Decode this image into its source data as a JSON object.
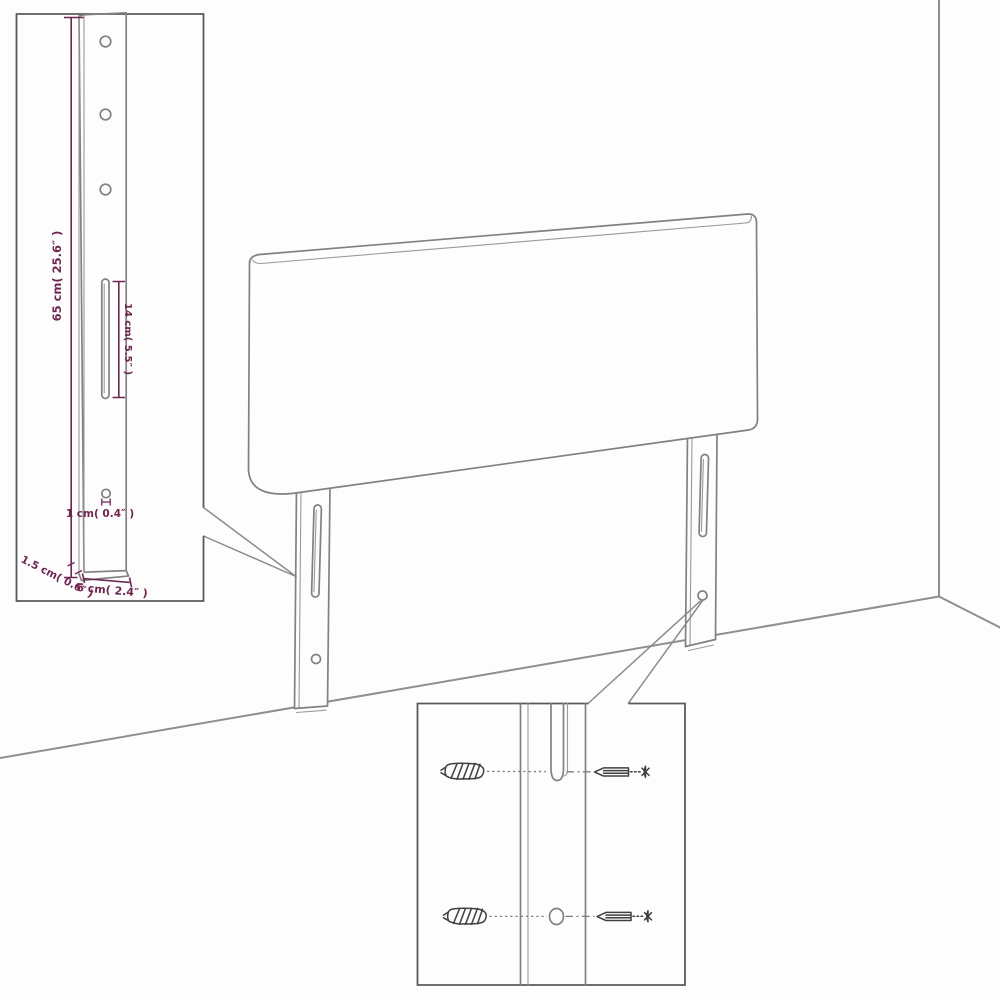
{
  "diagram": {
    "title": "headboard-assembly-dimension-diagram",
    "labels": {
      "leg_height": "65 cm( 25.6″ )",
      "slot_length": "14 cm( 5.5″ )",
      "hole_diameter": "1 cm( 0.4″ )",
      "thickness": "1.5 cm( 0.6″ )",
      "leg_width": "6 cm( 2.4″ )"
    },
    "colors": {
      "dimension": "#6e2750",
      "linework": "#818181",
      "inset_border": "#595959",
      "hardware": "#404040",
      "background": "#fdfdfd"
    }
  }
}
